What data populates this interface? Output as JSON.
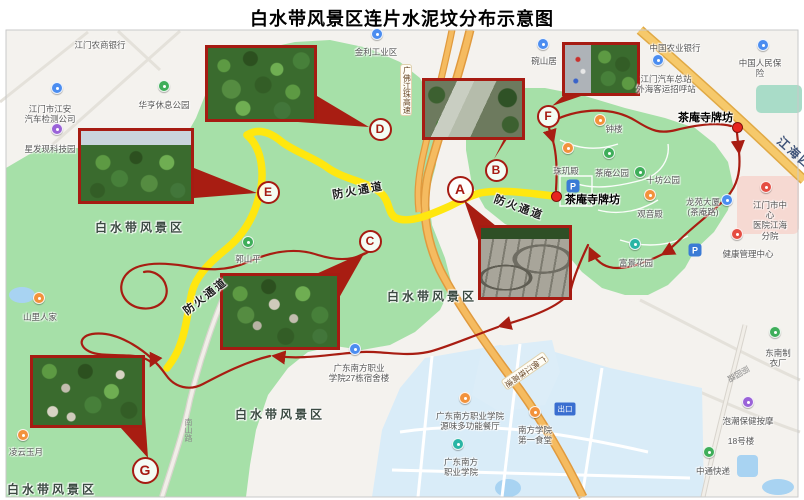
{
  "title": "白水带风景区连片水泥坟分布示意图",
  "colors": {
    "route_red": "#a81d12",
    "fire_road_yellow": "#ffe70f",
    "scenic_green": "#a6e0a8",
    "highway_orange": "#f5bb60",
    "campus_blue": "#d9ecf8",
    "gate_marker_red": "#e8251f"
  },
  "map": {
    "markers": [
      {
        "letter": "A",
        "x": 460,
        "y": 189,
        "size": "big"
      },
      {
        "letter": "B",
        "x": 496,
        "y": 170,
        "size": "small"
      },
      {
        "letter": "C",
        "x": 370,
        "y": 241,
        "size": "small"
      },
      {
        "letter": "D",
        "x": 380,
        "y": 129,
        "size": "small"
      },
      {
        "letter": "E",
        "x": 268,
        "y": 192,
        "size": "small"
      },
      {
        "letter": "F",
        "x": 548,
        "y": 116,
        "size": "small"
      },
      {
        "letter": "G",
        "x": 145,
        "y": 470,
        "size": "big"
      }
    ],
    "gates": [
      {
        "label": "茶庵寺牌坊",
        "dot_x": 737,
        "dot_y": 127,
        "label_x": 733,
        "label_y": 115,
        "align": "right"
      },
      {
        "label": "茶庵寺牌坊",
        "dot_x": 556,
        "dot_y": 196,
        "label_x": 565,
        "label_y": 197,
        "align": "left"
      }
    ],
    "photos": [
      {
        "id": "E",
        "kind": "k-sky-forest",
        "x": 78,
        "y": 128,
        "w": 116,
        "h": 76
      },
      {
        "id": "D",
        "kind": "k-canopy",
        "x": 205,
        "y": 45,
        "w": 112,
        "h": 77
      },
      {
        "id": "B",
        "kind": "k-rocks",
        "x": 422,
        "y": 78,
        "w": 103,
        "h": 62
      },
      {
        "id": "F",
        "kind": "k-road-trees",
        "x": 562,
        "y": 42,
        "w": 78,
        "h": 54
      },
      {
        "id": "A",
        "kind": "k-graves",
        "x": 478,
        "y": 225,
        "w": 94,
        "h": 75
      },
      {
        "id": "C",
        "kind": "k-canopy-graves",
        "x": 220,
        "y": 273,
        "w": 120,
        "h": 77
      },
      {
        "id": "G",
        "kind": "k-canopy-graves2",
        "x": 30,
        "y": 355,
        "w": 115,
        "h": 73
      }
    ],
    "area_labels": [
      {
        "text": "白水带风景区",
        "x": 140,
        "y": 227
      },
      {
        "text": "白水带风景区",
        "x": 432,
        "y": 296
      },
      {
        "text": "白水带风景区",
        "x": 280,
        "y": 414
      },
      {
        "text": "白水带风景区",
        "x": 52,
        "y": 489
      }
    ],
    "fire_labels": [
      {
        "text": "防火通道",
        "x": 358,
        "y": 190,
        "rot": -10
      },
      {
        "text": "防火通道",
        "x": 519,
        "y": 207,
        "rot": 20
      },
      {
        "text": "防火通道",
        "x": 205,
        "y": 296,
        "rot": -38
      }
    ],
    "road_labels": [
      {
        "text": "江海四路",
        "x": 772,
        "y": 149,
        "rot": 42,
        "cls": "rl-major"
      },
      {
        "text": "广佛江珠高速",
        "x": 400,
        "y": 64,
        "vertical": true,
        "cls": "rl-hw"
      },
      {
        "text": "广佛江珠高速",
        "x": 519,
        "y": 345,
        "rot": 55,
        "cls": "rl-hw",
        "vertical2": true
      },
      {
        "text": "南山路",
        "x": 183,
        "y": 418,
        "vertical": true,
        "cls": "rl-minor"
      },
      {
        "text": "丽园路",
        "x": 733,
        "y": 362,
        "rot": 60,
        "cls": "rl-minor",
        "vertical2": true
      }
    ],
    "pois": [
      {
        "text": "江门农商银行",
        "x": 100,
        "y": 40
      },
      {
        "text": "中国农业银行",
        "x": 675,
        "y": 43
      },
      {
        "text": "中国人民保险",
        "x": 760,
        "y": 58,
        "pin": {
          "color": "#4b8df0",
          "x": 763,
          "y": 45
        }
      },
      {
        "text": "江门汽车总站\n外海客运招呼站",
        "x": 666,
        "y": 74,
        "pin": {
          "color": "#4b8df0",
          "x": 658,
          "y": 60
        }
      },
      {
        "text": "金利工业区",
        "x": 376,
        "y": 47,
        "pin": {
          "color": "#4b8df0",
          "x": 377,
          "y": 34
        }
      },
      {
        "text": "碗山居",
        "x": 544,
        "y": 56,
        "pin": {
          "color": "#4b8df0",
          "x": 543,
          "y": 44
        }
      },
      {
        "text": "华亨休息公园",
        "x": 164,
        "y": 100,
        "pin": {
          "color": "#3fae5a",
          "x": 164,
          "y": 86
        }
      },
      {
        "text": "江门市江安\n汽车检测公司",
        "x": 50,
        "y": 104,
        "pin": {
          "color": "#4b8df0",
          "x": 57,
          "y": 88
        }
      },
      {
        "text": "星发现科技园",
        "x": 50,
        "y": 144,
        "pin": {
          "color": "#9a63d8",
          "x": 57,
          "y": 129
        }
      },
      {
        "text": "山里人家",
        "x": 40,
        "y": 312,
        "pin": {
          "color": "#f2923c",
          "x": 39,
          "y": 298
        }
      },
      {
        "text": "凌云玉月",
        "x": 26,
        "y": 447,
        "pin": {
          "color": "#f2923c",
          "x": 23,
          "y": 435
        }
      },
      {
        "text": "郭山平",
        "x": 248,
        "y": 254,
        "pin": {
          "color": "#3fae5a",
          "x": 248,
          "y": 242
        }
      },
      {
        "text": "钟楼",
        "x": 614,
        "y": 124,
        "pin": {
          "color": "#f2923c",
          "x": 600,
          "y": 120
        }
      },
      {
        "text": "珠玑殿",
        "x": 566,
        "y": 166,
        "pin": {
          "color": "#f2923c",
          "x": 568,
          "y": 148
        }
      },
      {
        "text": "茶庵公园",
        "x": 612,
        "y": 168,
        "pin": {
          "color": "#3fae5a",
          "x": 609,
          "y": 153
        }
      },
      {
        "text": "十坊公园",
        "x": 663,
        "y": 175,
        "pin": {
          "color": "#3fae5a",
          "x": 640,
          "y": 172
        }
      },
      {
        "text": "观音殿",
        "x": 650,
        "y": 209,
        "pin": {
          "color": "#f2923c",
          "x": 650,
          "y": 195
        }
      },
      {
        "text": "龙苑大厦\n(茶庵路)",
        "x": 703,
        "y": 197,
        "pin": {
          "color": "#4b8df0",
          "x": 727,
          "y": 200
        }
      },
      {
        "text": "江门市中心\n医院江海分院",
        "x": 770,
        "y": 200,
        "pin": {
          "color": "#e54d42",
          "x": 766,
          "y": 187
        }
      },
      {
        "text": "健康管理中心",
        "x": 748,
        "y": 249,
        "pin": {
          "color": "#e54d42",
          "x": 737,
          "y": 234
        }
      },
      {
        "text": "富景花园",
        "x": 636,
        "y": 258,
        "pin": {
          "color": "#2ab5a5",
          "x": 635,
          "y": 244
        }
      },
      {
        "text": "东南制衣厂",
        "x": 778,
        "y": 348,
        "pin": {
          "color": "#3fae5a",
          "x": 775,
          "y": 332
        }
      },
      {
        "text": "泡潮保健按摩",
        "x": 748,
        "y": 416,
        "pin": {
          "color": "#9a63d8",
          "x": 748,
          "y": 402
        }
      },
      {
        "text": "18号楼",
        "x": 741,
        "y": 436
      },
      {
        "text": "中通快递",
        "x": 713,
        "y": 466,
        "pin": {
          "color": "#3fae5a",
          "x": 709,
          "y": 452
        }
      },
      {
        "text": "广东南方职业\n学院27栋宿舍楼",
        "x": 359,
        "y": 363,
        "pin": {
          "color": "#4b8df0",
          "x": 355,
          "y": 349
        }
      },
      {
        "text": "广东南方职业学院\n源味多功能餐厅",
        "x": 470,
        "y": 411,
        "pin": {
          "color": "#f2923c",
          "x": 465,
          "y": 398
        }
      },
      {
        "text": "南方学院\n第一食堂",
        "x": 535,
        "y": 425,
        "pin": {
          "color": "#f2923c",
          "x": 535,
          "y": 412
        }
      },
      {
        "text": "广东南方\n职业学院",
        "x": 461,
        "y": 457,
        "pin": {
          "color": "#2ab5a5",
          "x": 458,
          "y": 444
        }
      }
    ],
    "badges": [
      {
        "type": "parking",
        "text": "P",
        "x": 573,
        "y": 186
      },
      {
        "type": "parking",
        "text": "P",
        "x": 695,
        "y": 250
      },
      {
        "type": "exit",
        "text": "出口",
        "x": 565,
        "y": 409
      }
    ]
  }
}
